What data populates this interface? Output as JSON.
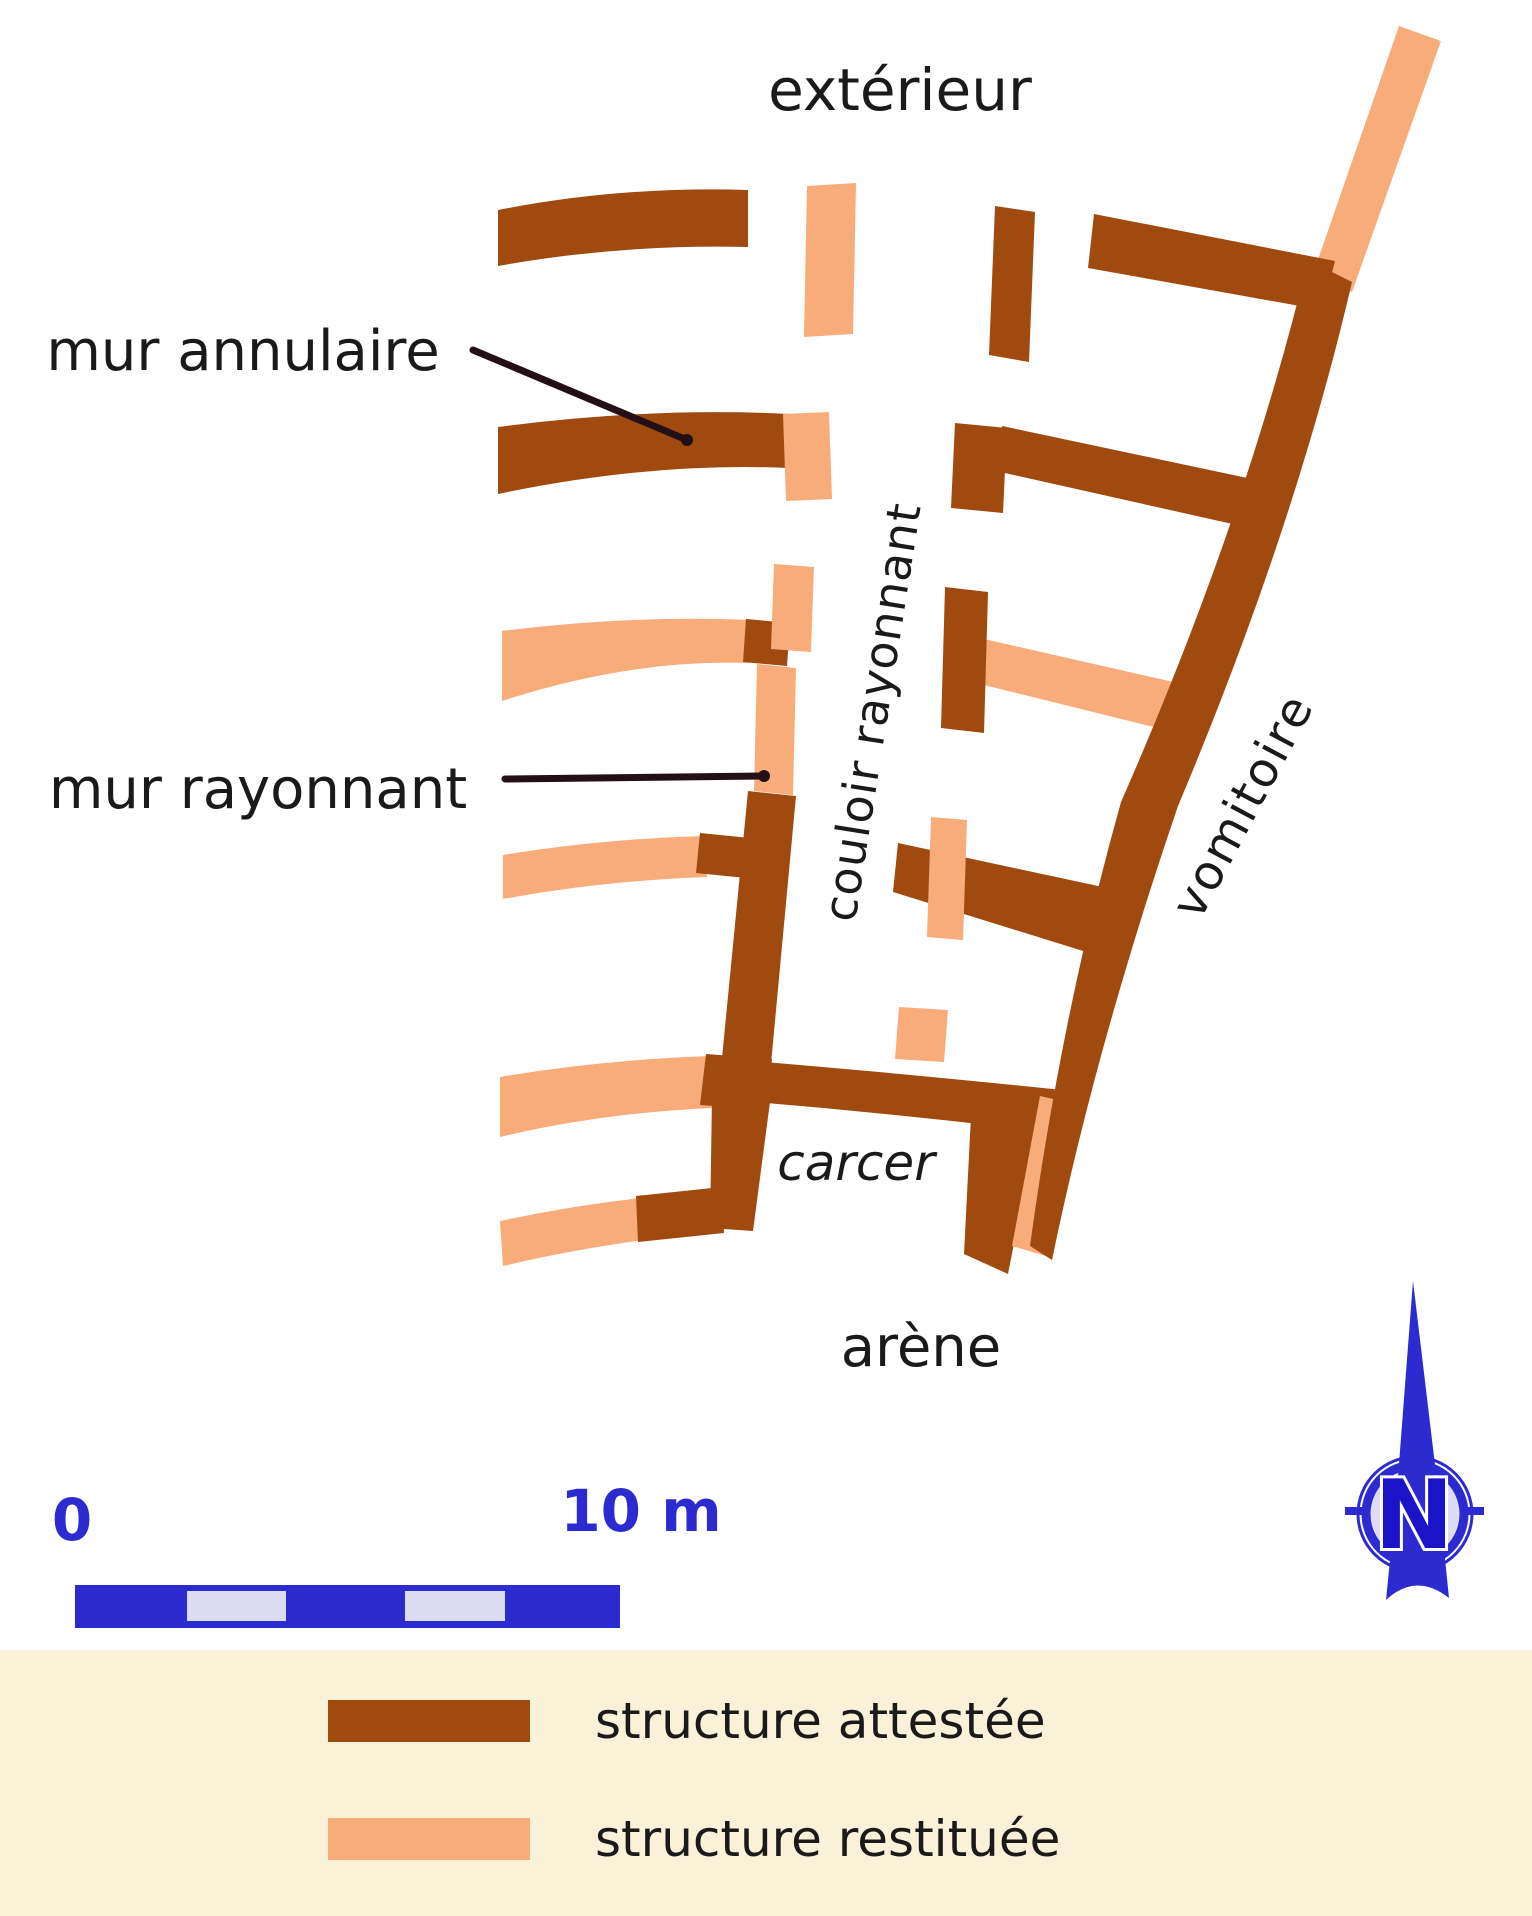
{
  "colors": {
    "attested": "#A04A10",
    "restored": "#F7AC7A",
    "blue": "#2B2BD0",
    "blue_dark": "#1A14C8",
    "blue_light": "#DCDCF2",
    "cream": "#FAF2D8",
    "ink": "#1A1A1A",
    "leader": "#231016"
  },
  "plan": {
    "labels": [
      {
        "name": "label-exterieur",
        "text": "extérieur",
        "cx": 900,
        "cy": 90,
        "size": 58
      },
      {
        "name": "label-mur-annulaire",
        "text": "mur annulaire",
        "cx": 243,
        "cy": 352,
        "size": 56
      },
      {
        "name": "label-mur-rayonnant",
        "text": "mur rayonnant",
        "cx": 258,
        "cy": 790,
        "size": 56
      },
      {
        "name": "label-couloir-rayonnant",
        "text": "couloir rayonnant",
        "cx": 872,
        "cy": 712,
        "size": 46,
        "rotate": -81,
        "spacing": 1
      },
      {
        "name": "label-vomitoire",
        "text": "vomitoire",
        "cx": 1243,
        "cy": 806,
        "size": 48,
        "rotate": -62,
        "spacing": 2
      },
      {
        "name": "label-carcer",
        "text": "carcer",
        "cx": 856,
        "cy": 1163,
        "size": 50,
        "italic": true
      },
      {
        "name": "label-arene",
        "text": "arène",
        "cx": 921,
        "cy": 1348,
        "size": 56
      },
      {
        "name": "label-scale-0",
        "text": "0",
        "cx": 72,
        "cy": 1520,
        "size": 58,
        "color": "blue"
      },
      {
        "name": "label-scale-10m",
        "text": "10 m",
        "cx": 641,
        "cy": 1511,
        "size": 58,
        "color": "blue"
      }
    ],
    "callouts": [
      {
        "name": "mur-annulaire-leader",
        "x1": 473,
        "y1": 350,
        "x2": 687,
        "y2": 440,
        "dot_x": 687,
        "dot_y": 440
      },
      {
        "name": "mur-rayonnant-leader",
        "x1": 505,
        "y1": 779,
        "x2": 764,
        "y2": 776,
        "dot_x": 764,
        "dot_y": 776
      }
    ],
    "walls": [
      {
        "name": "wall-restored-top-diagonal",
        "kind": "restored",
        "d": "M1399,26 L1441,41 L1352,292 L1312,277 Z"
      },
      {
        "name": "wall-attested-ring1-right",
        "kind": "attested",
        "d": "M1094,214 L1335,261 L1322,310 L1088,268 Z"
      },
      {
        "name": "wall-attested-ring2-right-band",
        "kind": "attested",
        "d": "M1002,426 L1290,487 L1277,534 L996,471 Z"
      },
      {
        "name": "wall-restored-ring3-right-band",
        "kind": "restored",
        "d": "M984,639 L1182,684 L1170,731 L980,684 Z"
      },
      {
        "name": "wall-attested-ring4-right-band",
        "kind": "attested",
        "d": "M898,843 L1112,889 L1096,955 L893,892 Z"
      },
      {
        "name": "wall-restored-ring4-right-stub",
        "kind": "restored",
        "d": "M931,817 L967,820 L963,940 L927,937 Z"
      },
      {
        "name": "wall-attested-carcer-top-band",
        "kind": "attested",
        "d": "M705,1057 Q890,1072 1062,1090 L1056,1133 Q885,1112 716,1099 Z"
      },
      {
        "name": "wall-attested-carcer-right",
        "kind": "attested",
        "d": "M972,1096 L1038,1122 L1008,1274 L964,1254 Z"
      },
      {
        "name": "wall-restored-vomitoire-sliver",
        "kind": "restored",
        "d": "M1040,1096 L1066,1102 L1046,1256 L1012,1246 Z"
      },
      {
        "name": "wall-attested-vomitoire-outer",
        "kind": "attested",
        "d": "M1308,260 L1352,282 Q1295,528 1178,806 Q1096,1046 1052,1260 L1030,1246 Q1062,1012 1121,802 Q1245,520 1308,260 Z"
      },
      {
        "name": "wall-attested-radial-top",
        "kind": "attested",
        "d": "M995,206 L1035,212 L1029,362 L989,355 Z"
      },
      {
        "name": "wall-attested-ring2-right-stub",
        "kind": "attested",
        "d": "M955,423 L1007,428 L1003,513 L951,508 Z"
      },
      {
        "name": "wall-attested-ring3-right-bar",
        "kind": "attested",
        "d": "M945,587 L988,592 L984,733 L941,728 Z"
      },
      {
        "name": "wall-attested-ring1-left",
        "kind": "attested",
        "d": "M498,210 Q620,186 748,190 L748,247 Q620,244 498,266 Z"
      },
      {
        "name": "wall-attested-ring2-left",
        "kind": "attested",
        "d": "M498,427 Q650,407 790,414 L790,468 Q650,462 498,494 Z"
      },
      {
        "name": "wall-restored-ring3-left",
        "kind": "restored",
        "d": "M502,631 Q630,615 750,620 L750,663 Q630,659 502,701 Z"
      },
      {
        "name": "wall-attested-ring3-left-end",
        "kind": "attested",
        "d": "M746,619 L790,623 L787,666 L743,662 Z"
      },
      {
        "name": "wall-restored-ring4-left",
        "kind": "restored",
        "d": "M503,855 Q600,839 704,836 L707,877 Q600,881 503,899 Z"
      },
      {
        "name": "wall-attested-ring4-left-end",
        "kind": "attested",
        "d": "M700,833 L750,838 L746,878 L696,873 Z"
      },
      {
        "name": "wall-restored-ring5-left",
        "kind": "restored",
        "d": "M500,1077 Q600,1060 710,1056 L713,1108 Q600,1113 500,1137 Z"
      },
      {
        "name": "wall-attested-ring5-junction",
        "kind": "attested",
        "d": "M706,1054 L772,1059 L766,1110 L700,1105 Z"
      },
      {
        "name": "wall-restored-radial-top-bar",
        "kind": "restored",
        "d": "M807,186 L856,183 L853,334 L804,337 Z"
      },
      {
        "name": "wall-restored-ring2-stub",
        "kind": "restored",
        "d": "M783,414 L829,412 L832,499 L786,501 Z"
      },
      {
        "name": "wall-restored-radial-mid-stub",
        "kind": "restored",
        "d": "M774,564 L814,567 L811,652 L771,649 Z"
      },
      {
        "name": "wall-restored-mur-rayonnant",
        "kind": "restored",
        "d": "M757,664 L796,668 L793,795 L754,791 Z"
      },
      {
        "name": "wall-attested-radial-mid",
        "kind": "attested",
        "d": "M748,791 L796,796 L771,1064 L722,1058 Z"
      },
      {
        "name": "wall-restored-ring5-right-stub",
        "kind": "restored",
        "d": "M899,1007 L948,1010 L944,1062 L895,1059 Z"
      },
      {
        "name": "wall-restored-ring6-left",
        "kind": "restored",
        "d": "M500,1221 Q570,1206 640,1198 L644,1240 Q570,1250 503,1266 Z"
      },
      {
        "name": "wall-attested-carcer-arm",
        "kind": "attested",
        "d": "M636,1196 L722,1187 L724,1233 L638,1242 Z"
      },
      {
        "name": "wall-attested-carcer-left",
        "kind": "attested",
        "d": "M712,1097 L770,1102 L753,1231 L710,1228 Z"
      }
    ]
  },
  "scale_bar": {
    "x": 75,
    "y": 1585,
    "width": 545,
    "height": 43,
    "segments": [
      {
        "x": 187,
        "y": 1591,
        "w": 99,
        "h": 30
      },
      {
        "x": 405,
        "y": 1591,
        "w": 100,
        "h": 30
      }
    ]
  },
  "north_arrow": {
    "label": "N"
  },
  "legend": {
    "band_top": 1650,
    "band_height": 266,
    "swatch_x": 328,
    "swatch_w": 202,
    "swatch_h": 42,
    "label_x": 595,
    "items": [
      {
        "kind": "attested",
        "label": "structure attestée",
        "y": 1700
      },
      {
        "kind": "restored",
        "label": "structure restituée",
        "y": 1818
      }
    ]
  }
}
